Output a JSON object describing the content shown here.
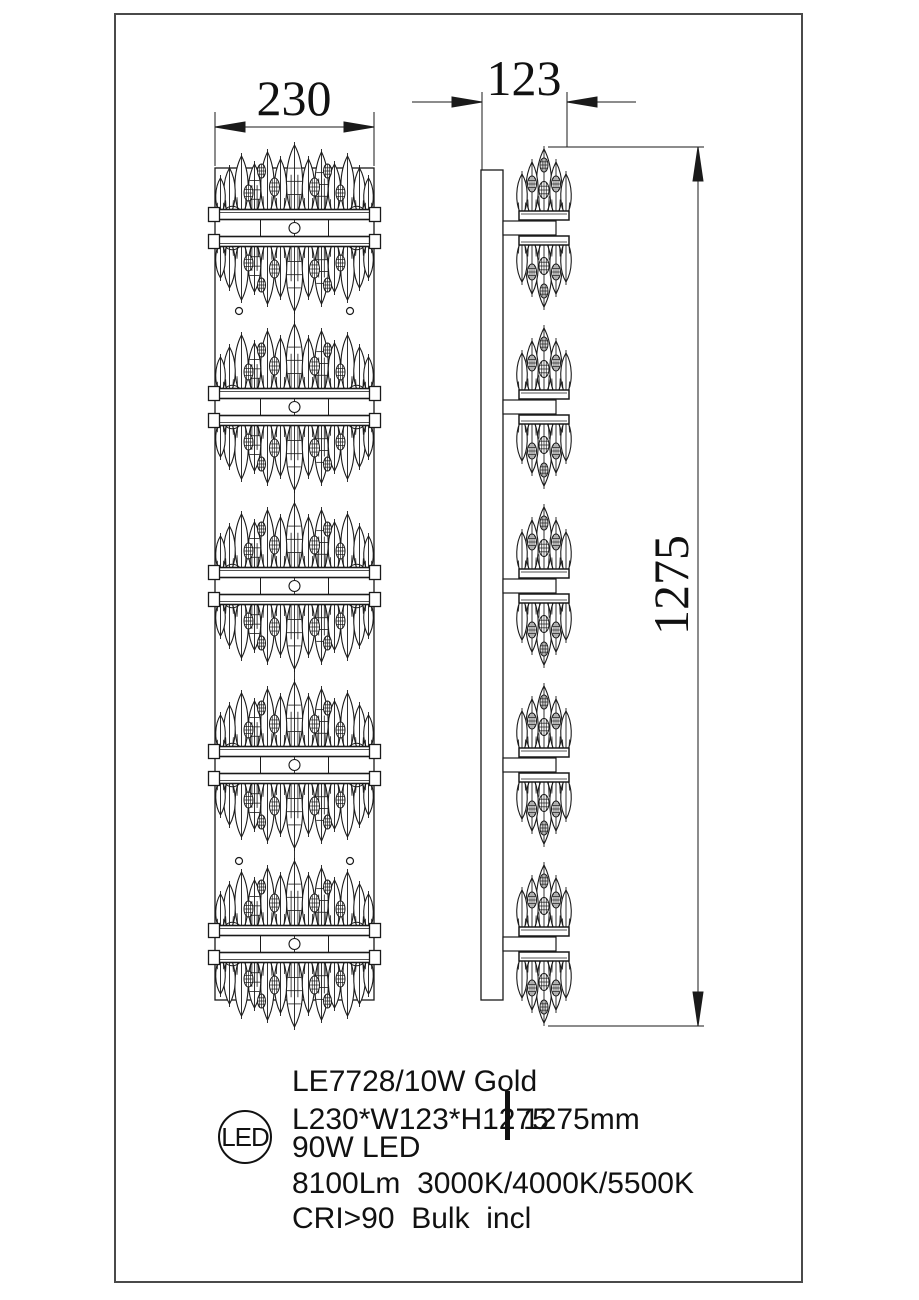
{
  "drawing": {
    "dim_width": "230",
    "dim_depth": "123",
    "dim_height": "1275",
    "tiers": 5,
    "screw_hole_rows": 2
  },
  "specs": {
    "model": "LE7728/10W Gold",
    "size": "L230*W123*H1275",
    "drop": "1275mm",
    "power": "90W LED",
    "output": "8100Lm  3000K/4000K/5500K",
    "cri": "CRI>90  Bulk  incl",
    "badge": "LED"
  },
  "colors": {
    "line": "#1a1a1a",
    "frame": "#4a4a4a",
    "bg": "#ffffff"
  }
}
